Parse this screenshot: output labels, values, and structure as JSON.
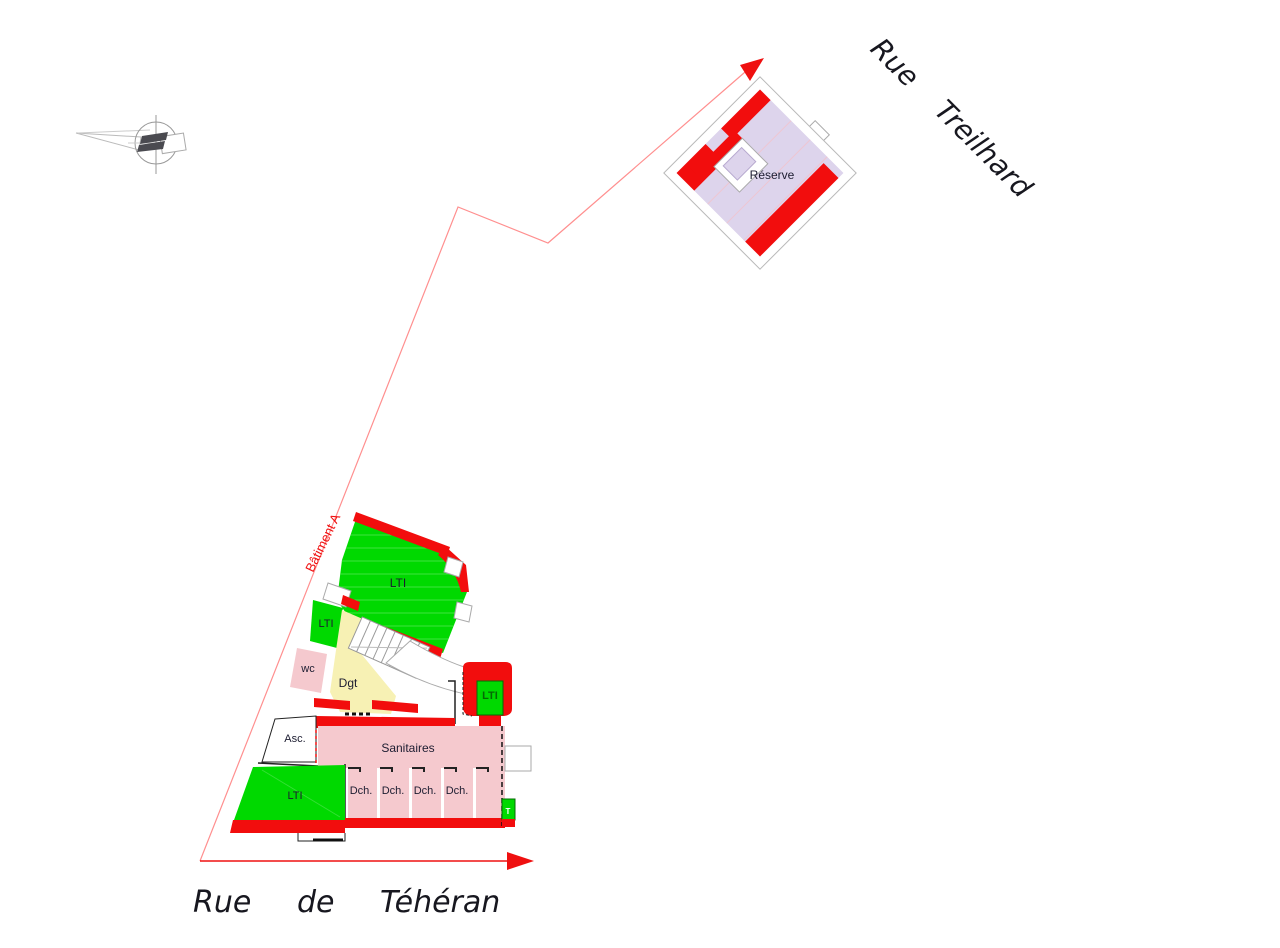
{
  "streets": {
    "treilhard": {
      "word1": "Rue",
      "word2": "Treilhard"
    },
    "teheran": {
      "word1": "Rue",
      "word2": "de",
      "word3": "Téhéran"
    }
  },
  "boundary": {
    "label": "Bâtiment A"
  },
  "annex": {
    "room": "Réserve"
  },
  "building": {
    "rooms": {
      "lti_main": "LTI",
      "lti_small": "LTI",
      "wc": "wc",
      "dgt": "Dgt",
      "asc": "Asc.",
      "sanitaires": "Sanitaires",
      "dch_1": "Dch.",
      "dch_2": "Dch.",
      "dch_3": "Dch.",
      "dch_4": "Dch.",
      "lti_right": "LTI",
      "lti_bottom": "LTI",
      "t_small": "T"
    }
  },
  "colors": {
    "wall_red": "#f20d0d",
    "lti_green": "#00d900",
    "sanitary_pink": "#f5c9ce",
    "reserve_lavender": "#ddd4ec",
    "circulation_yellow": "#f7f1b4",
    "boundary_red": "#ff8f8f",
    "arrow_red": "#ef1010",
    "label_ink": "#1c1c30",
    "lti_right_ink": "#046a04"
  }
}
